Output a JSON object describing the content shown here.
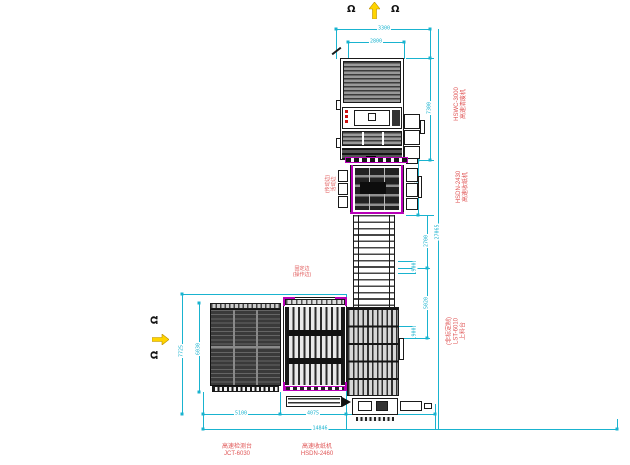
{
  "icons": {
    "operator": "Ω"
  },
  "colors": {
    "dimension": "#19b3cf",
    "label_red": "#e05555",
    "magenta": "#b800b8",
    "arrow_yellow": "#ffd400",
    "machine_dark": "#1a1a1a"
  },
  "machines": {
    "hswc": {
      "name": "高速清废机",
      "model": "HSWC-3000"
    },
    "hsdn2430": {
      "name": "高速收纸机",
      "model": "HSDN-2430"
    },
    "lst": {
      "name": "上料台",
      "model": "LST-6010",
      "note": "(非标定制)"
    },
    "jct": {
      "name": "高速检测台",
      "model": "JCT-6030"
    },
    "hsdn2460": {
      "name": "高速收纸机",
      "model": "HSDN-2460"
    }
  },
  "annotations": {
    "edge_movable": {
      "primary": "活动边",
      "secondary": "(传动边)"
    },
    "edge_fixed": {
      "primary": "固定边",
      "secondary": "(操作边)"
    }
  },
  "dimensions": {
    "top_outer": "3300",
    "top_inner": "2800",
    "right_hswc": "7300",
    "right_hsdn": "4075",
    "right_mid": "2700",
    "right_900a": "900",
    "right_lst": "5020",
    "right_900b": "900",
    "right_total": "27065",
    "bottom_1": "5100",
    "bottom_2": "4075",
    "bottom_3": "2400",
    "bottom_total": "14846",
    "left_outer": "7725",
    "left_inner": "6030"
  }
}
